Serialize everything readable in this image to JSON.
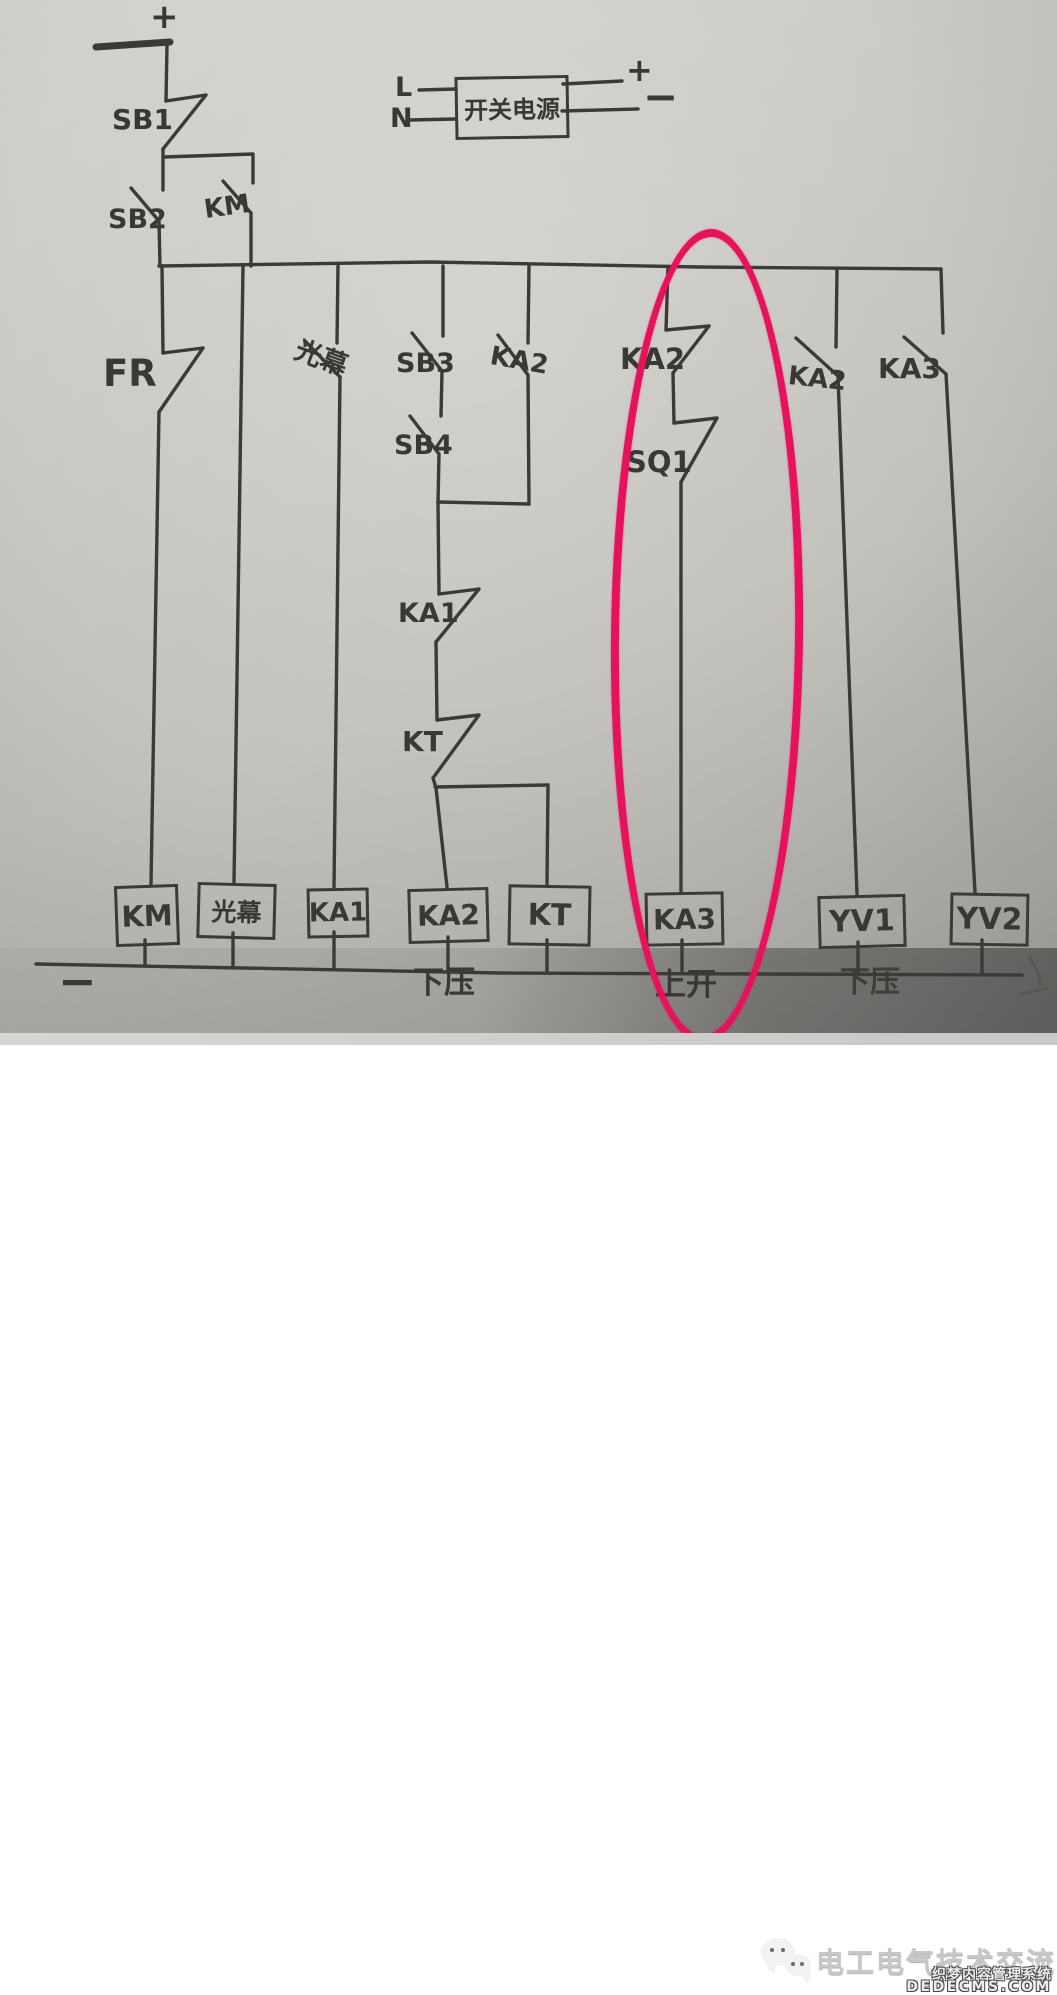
{
  "supply": {
    "plus_top": "+",
    "line_label": "L",
    "neutral_label": "N",
    "psu_label": "开关电源",
    "plus_right": "+",
    "minus_right": "−",
    "minus_bottom": "−"
  },
  "contacts": {
    "sb1": "SB1",
    "sb2": "SB2",
    "km": "KM",
    "fr": "FR",
    "light_curtain": "光幕",
    "sb3": "SB3",
    "sb4": "SB4",
    "ka2_parallel": "KA2",
    "ka1": "KA1",
    "kt": "KT",
    "ka2_circled": "KA2",
    "sq1": "SQ1",
    "ka2_right": "KA2",
    "ka3_right": "KA3"
  },
  "coils": {
    "km": "KM",
    "light_curtain": "光幕",
    "ka1": "KA1",
    "ka2": "KA2",
    "kt": "KT",
    "ka3": "KA3",
    "yv1": "YV1",
    "yv2": "YV2"
  },
  "annotations": {
    "down_press": "下压",
    "up_open": "上开",
    "obscured_label": "下压"
  },
  "watermark": {
    "channel_name": "电工电气技术交流",
    "cms_name": "织梦内容管理系统",
    "cms_domain": "DEDECMS.COM"
  },
  "colors": {
    "ink": "#3b3a37",
    "paper": "#c9c7c2",
    "highlight_red": "#e6135c",
    "watermark_gray": "#c3c3c2"
  }
}
